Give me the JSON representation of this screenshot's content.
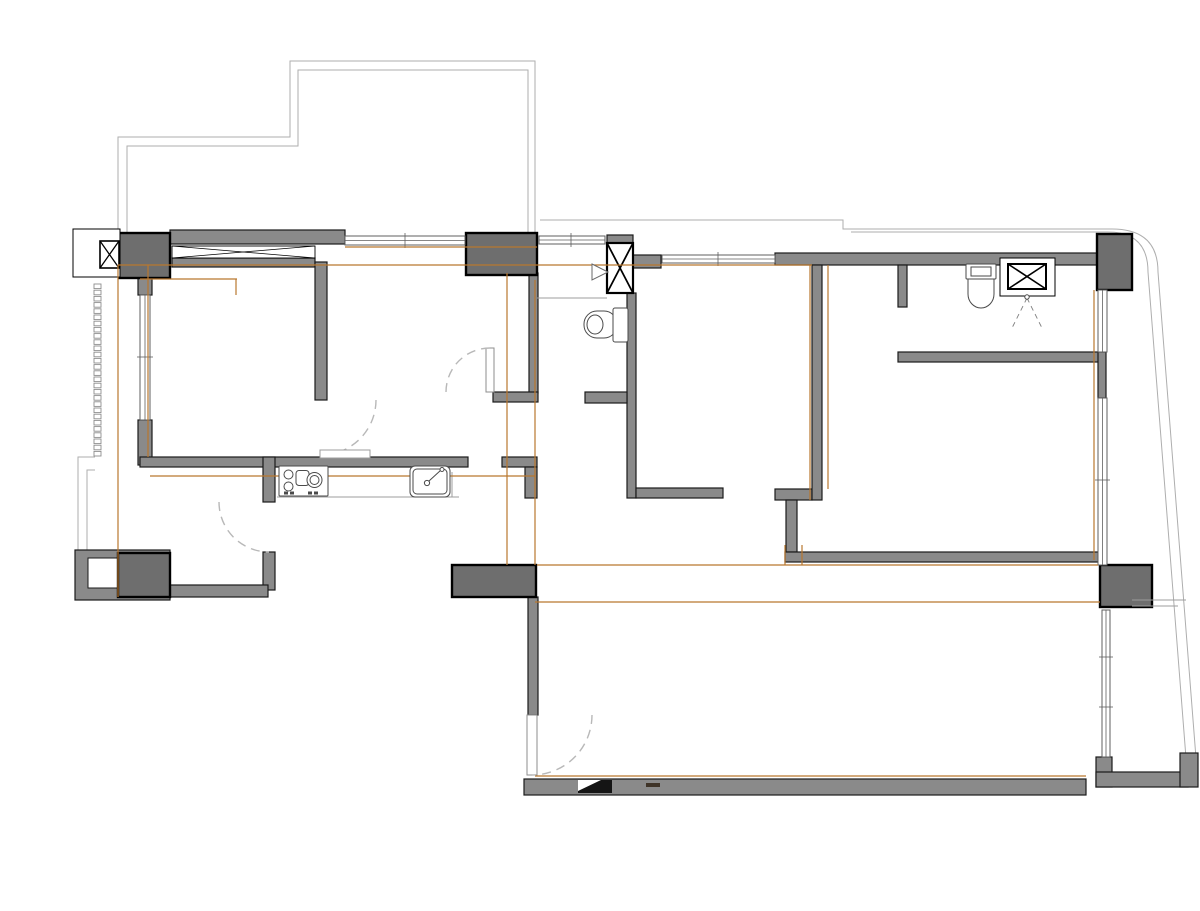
{
  "document": {
    "kind": "architectural-floor-plan",
    "canvas": {
      "width": 1200,
      "height": 911,
      "background": "#ffffff"
    }
  },
  "plan": {
    "colors": {
      "wall_fill": "#8a8a8a",
      "wall_stroke": "#1b1b1b",
      "column_fill": "#6e6e6e",
      "column_stroke": "#000000",
      "window_stroke": "#5f5f5f",
      "boundary": "#aeaeae",
      "guide_orange": "#b9772e",
      "door_arc": "#b8b8b8",
      "thin_line": "#9c9c9c",
      "fixture_stroke": "#4a4a4a",
      "wedge_fill": "#151515"
    },
    "boundary_paths": [
      "M118,235 V137 H290 V61 H535 V232",
      "M127,235 V146 H298 V70 H528 V232",
      "M540,220 H843 V229 H1112 Q1158,229 1158,272 L1196,758",
      "M851,232 H1108 Q1148,232 1148,272 L1186,758",
      "M95,457 H78 V552",
      "M95,470 H87 V552"
    ],
    "orange_lines": [
      [
        118,
        265,
        812,
        265
      ],
      [
        345,
        247,
        537,
        247
      ],
      [
        118,
        265,
        118,
        597
      ],
      [
        148,
        265,
        148,
        457
      ],
      [
        150,
        476,
        535,
        476
      ],
      [
        507,
        273,
        507,
        565
      ],
      [
        535,
        280,
        535,
        565
      ],
      [
        537,
        565,
        1098,
        565
      ],
      [
        535,
        602,
        1100,
        602
      ],
      [
        810,
        265,
        810,
        500
      ],
      [
        828,
        265,
        828,
        489
      ],
      [
        785,
        545,
        785,
        565
      ],
      [
        802,
        545,
        802,
        565
      ],
      [
        535,
        776,
        1086,
        776
      ],
      [
        1094,
        290,
        1094,
        560
      ],
      [
        140,
        279,
        237,
        279
      ],
      [
        236,
        279,
        236,
        295
      ]
    ],
    "walls": [
      [
        170,
        230,
        175,
        14,
        "top-wall-left"
      ],
      [
        172,
        258,
        143,
        9,
        "closet-base"
      ],
      [
        607,
        235,
        26,
        8,
        "shaft-cap"
      ],
      [
        775,
        253,
        325,
        12,
        "top-wall-right"
      ],
      [
        633,
        255,
        28,
        13,
        "entry-stub"
      ],
      [
        898,
        265,
        9,
        42,
        "bath2-stub"
      ],
      [
        138,
        278,
        14,
        17,
        "left-wall-upper-stub"
      ],
      [
        138,
        420,
        14,
        45,
        "left-wall-lower"
      ],
      [
        315,
        262,
        12,
        138,
        "bedroom1-closet-wall"
      ],
      [
        529,
        273,
        9,
        120,
        "center-wall-vert"
      ],
      [
        493,
        392,
        45,
        10,
        "center-wall-horiz"
      ],
      [
        140,
        457,
        328,
        10,
        "kitchen-north-wall-a"
      ],
      [
        502,
        457,
        35,
        10,
        "kitchen-north-wall-b"
      ],
      [
        525,
        467,
        12,
        31,
        "kitchen-east-wall"
      ],
      [
        263,
        457,
        12,
        45,
        "dining-wall-upper"
      ],
      [
        263,
        552,
        12,
        38,
        "dining-wall-lower"
      ],
      [
        168,
        585,
        100,
        12,
        "bottom-left-wall"
      ],
      [
        75,
        550,
        95,
        50,
        "bottom-left-ledge"
      ],
      [
        528,
        597,
        10,
        118,
        "living-west-wall"
      ],
      [
        524,
        779,
        562,
        16,
        "bottom-wall"
      ],
      [
        627,
        293,
        9,
        205,
        "bath1-east-wall"
      ],
      [
        585,
        392,
        42,
        11,
        "bath1-south-stub"
      ],
      [
        636,
        488,
        87,
        10,
        "hall-south-wall"
      ],
      [
        775,
        489,
        37,
        11,
        "bedroom2-stub"
      ],
      [
        812,
        265,
        10,
        235,
        "bedroom2-west-wall"
      ],
      [
        786,
        500,
        11,
        52,
        "bedroom2-lower-wall"
      ],
      [
        785,
        552,
        315,
        10,
        "mid-bottom-wall"
      ],
      [
        898,
        352,
        202,
        10,
        "right-divider-wall"
      ],
      [
        1098,
        352,
        8,
        46,
        "right-wall-piece"
      ],
      [
        1096,
        757,
        16,
        30,
        "br-balcony-left"
      ],
      [
        1096,
        772,
        92,
        15,
        "br-balcony-bottom"
      ],
      [
        1180,
        753,
        18,
        34,
        "br-balcony-right"
      ]
    ],
    "white_cutouts": [
      [
        88,
        558,
        30,
        30,
        "bl-ledge-opening"
      ]
    ],
    "columns": [
      [
        119,
        233,
        51,
        45,
        "column-top-left"
      ],
      [
        466,
        233,
        71,
        42,
        "column-top-center"
      ],
      [
        1097,
        234,
        35,
        56,
        "column-top-right"
      ],
      [
        118,
        553,
        52,
        44,
        "column-bottom-left"
      ],
      [
        452,
        565,
        84,
        32,
        "column-bottom-center"
      ],
      [
        1100,
        565,
        52,
        42,
        "column-bottom-right"
      ]
    ],
    "windows": [
      {
        "x": 345,
        "y": 236,
        "w": 120,
        "h": 9,
        "orient": "h",
        "mullions": [
          405
        ],
        "name": "window-top-1"
      },
      {
        "x": 539,
        "y": 236,
        "w": 66,
        "h": 8,
        "orient": "h",
        "mullions": [
          571
        ],
        "name": "window-entry"
      },
      {
        "x": 662,
        "y": 255,
        "w": 113,
        "h": 8,
        "orient": "h",
        "mullions": [
          718
        ],
        "name": "window-top-2"
      },
      {
        "x": 140,
        "y": 295,
        "w": 10,
        "h": 125,
        "orient": "v",
        "mullions": [
          357
        ],
        "name": "window-left"
      },
      {
        "x": 1098,
        "y": 290,
        "w": 9,
        "h": 62,
        "orient": "v",
        "mullions": [],
        "name": "window-right-upper"
      },
      {
        "x": 1098,
        "y": 398,
        "w": 9,
        "h": 167,
        "orient": "v",
        "mullions": [
          480
        ],
        "name": "window-right-mid"
      },
      {
        "x": 1102,
        "y": 610,
        "w": 8,
        "h": 147,
        "orient": "v",
        "mullions": [
          657,
          707
        ],
        "name": "window-right-lower"
      }
    ],
    "xboxes": [
      {
        "rect": [
          73,
          229,
          47,
          48
        ],
        "sw": 1,
        "cross": false,
        "name": "ac-ledge-outline"
      },
      {
        "rect": [
          100,
          241,
          19,
          27
        ],
        "sw": 1.6,
        "cross": true,
        "name": "duct-box-left"
      },
      {
        "rect": [
          607,
          243,
          26,
          50
        ],
        "sw": 2.2,
        "cross": true,
        "name": "entry-shaft"
      },
      {
        "rect": [
          172,
          246,
          143,
          12
        ],
        "sw": 0.9,
        "cross": true,
        "name": "closet-hatch"
      },
      {
        "rect": [
          1000,
          258,
          55,
          38
        ],
        "sw": 1,
        "cross": false,
        "name": "bath-cabinet-outline"
      },
      {
        "rect": [
          1008,
          264,
          38,
          25
        ],
        "sw": 2,
        "cross": true,
        "name": "bath-cabinet-box"
      }
    ],
    "ladder": {
      "x": 94,
      "y0": 284,
      "w": 7,
      "h": 4.6,
      "step": 6.2,
      "count": 28
    },
    "construction_lines": [
      [
        537,
        298,
        607,
        298
      ],
      [
        277,
        497,
        459,
        497
      ],
      [
        452,
        472,
        452,
        497
      ],
      [
        1132,
        600,
        1186,
        600
      ],
      [
        1132,
        606,
        1178,
        606
      ]
    ],
    "door_leaves": [
      [
        486,
        348,
        8,
        44,
        "door-leaf-center"
      ],
      [
        527,
        715,
        10,
        60,
        "door-leaf-terrace"
      ]
    ],
    "door_arcs": [
      {
        "d": "M376,400 A55,55 0 0 1 321,455",
        "name": "door-arc-bedroom1"
      },
      {
        "d": "M446,392 A44,44 0 0 1 490,348",
        "name": "door-arc-center"
      },
      {
        "d": "M219,502 A50,50 0 0 0 269,552",
        "name": "door-arc-dining"
      },
      {
        "d": "M592,715 A60,60 0 0 1 532,775",
        "name": "door-arc-terrace"
      }
    ],
    "cabinet_dashes": [
      [
        1027,
        298,
        1011,
        330
      ],
      [
        1027,
        298,
        1043,
        330
      ]
    ],
    "fixtures": {
      "stove": {
        "x": 279,
        "y": 466
      },
      "kitchen-sink": {
        "x": 410,
        "y": 466
      },
      "toilet-1": {
        "x": 584,
        "y": 306
      },
      "toilet-2": {
        "x": 966,
        "y": 262
      },
      "bath-cabinet-knob": {
        "x": 1025,
        "y": 294
      },
      "entry-arrow": {
        "x": 592,
        "y": 264
      },
      "threshold-wedge": {
        "x": 578,
        "y": 780
      },
      "wedge-dash": {
        "x": 646,
        "y": 783
      },
      "counter-ledge": {
        "x": 320,
        "y": 450
      }
    }
  }
}
